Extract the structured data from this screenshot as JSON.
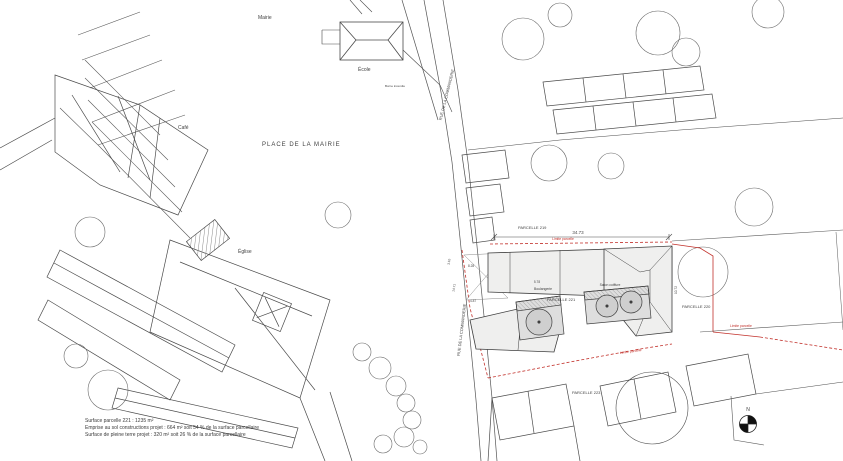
{
  "colors": {
    "ink": "#4a4a4a",
    "ink_light": "#6f6f6f",
    "red": "#c2312b",
    "fill_light": "#efefee",
    "fill_mid": "#d9d9d9",
    "fill_dark": "#c9c9c9"
  },
  "labels": {
    "mairie": "Mairie",
    "ecole": "École",
    "cafe": "Café",
    "eglise": "Église",
    "place": "PLACE DE LA MAIRIE",
    "street_top": "RUE DE LA COMMANDERIE",
    "street_bottom": "RUE DE LA COMMANDERIE",
    "parcelle_219": "PARCELLE 219",
    "parcelle_220": "PARCELLE 220",
    "parcelle_221": "PARCELLE 221",
    "parcelle_223": "PARCELLE 223",
    "shop_left": "Boulangerie",
    "shop_right": "Salon coiffure",
    "hydrant": "Borne incendie",
    "north": "N"
  },
  "limits": {
    "top": "Limite parcelle",
    "right": "Limite parcelle",
    "bottom": "Limite parcelle"
  },
  "dimensions": {
    "front": "34.73",
    "d1": "5.78",
    "d2": "8.28",
    "d3": "4.87",
    "d4": "14.71",
    "d5": "3.10",
    "d6": "10.72"
  },
  "summary": {
    "line1": "Surface parcelle 221 : 1235 m²",
    "line2": "Emprise au sol constructions projet : 664 m² soit 54 % de la surface parcellaire",
    "line3": "Surface de pleine terre projet : 320 m² soit 26 % de la surface parcellaire"
  }
}
